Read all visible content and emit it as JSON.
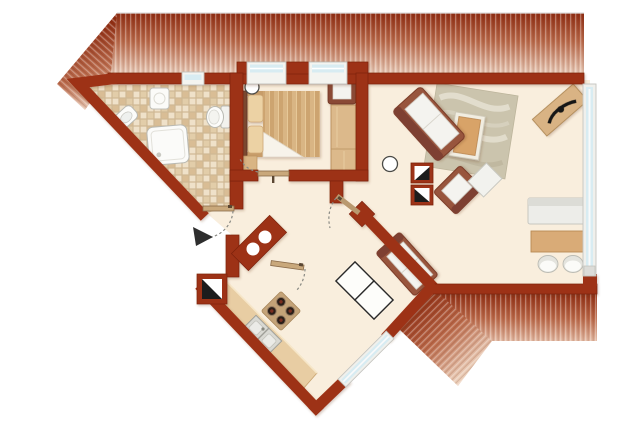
{
  "meta": {
    "description": "Apartment floor plan with bathroom, bedroom, living-dining room, diagonal kitchen, entrance hall, striped awning at top and striped terrace at bottom right"
  },
  "palette": {
    "background": "#ffffff",
    "wall_red": "#9d3318",
    "wall_red_dark": "#7c2108",
    "floor_cream": "#f9eedd",
    "awning_dark": "#8f2d12",
    "awning_light": "#ecd2bf",
    "tile_beige": "#e9d8bc",
    "wood": "#d9b584",
    "furniture_brown": "#96523c",
    "fixture_white": "#fbfbf8",
    "glazing_blue": "#d8ecf2",
    "swing_arc_grey": "#8a8a84",
    "symbol_black": "#1c1c1c"
  },
  "rooms": [
    {
      "id": "bathroom",
      "label": "bathroom",
      "features": [
        "tiled floor",
        "boiler cabinet",
        "washbasin",
        "shower",
        "toilet",
        "small window",
        "door with swing"
      ]
    },
    {
      "id": "bedroom",
      "label": "bedroom",
      "features": [
        "double bed with two pillows",
        "wardrobe",
        "side chair",
        "ceiling light",
        "two windows",
        "door"
      ]
    },
    {
      "id": "living-dining",
      "label": "living-dining room",
      "features": [
        "sofa",
        "swirl rug",
        "coffee table",
        "armchair",
        "side table",
        "duct shafts",
        "ceiling light",
        "diagonal sideboard with decor",
        "lowboard",
        "dining table",
        "two chairs",
        "bench sofa",
        "panorama window"
      ]
    },
    {
      "id": "kitchen",
      "label": "kitchen",
      "features": [
        "diagonal counter",
        "cooktop with 4 burners",
        "double sink",
        "square table for two",
        "glazed terrace door",
        "duct shaft"
      ]
    },
    {
      "id": "hall",
      "label": "entrance hall",
      "features": [
        "entrance arrow",
        "utility block with two basins",
        "door swings"
      ]
    },
    {
      "id": "outdoor",
      "label": "outdoor areas",
      "features": [
        "striped awning top",
        "striped terrace bottom right"
      ]
    }
  ],
  "counts": {
    "cooktop_burners": 4,
    "bedroom_windows": 2,
    "dining_chairs": 2,
    "duct_shafts": 3,
    "ceiling_lights": 2
  }
}
